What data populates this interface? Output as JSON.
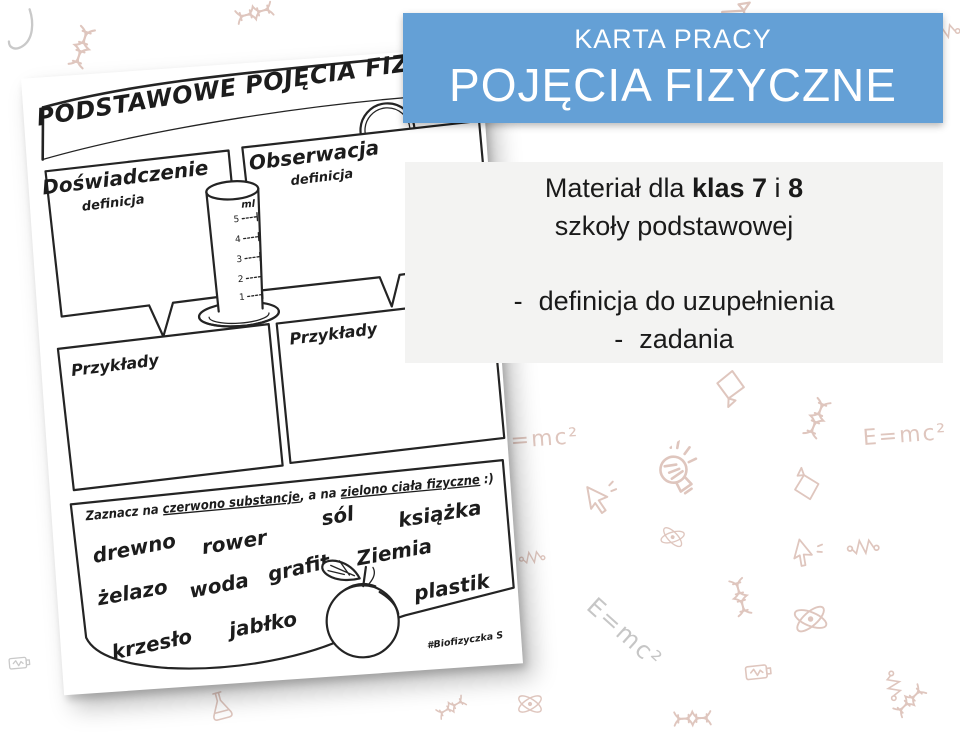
{
  "slide": {
    "background_color": "#ffffff",
    "banner": {
      "kicker": "KARTA PRACY",
      "title": "POJĘCIA FIZYCZNE",
      "bg_color": "#64a0d6",
      "text_color": "#ffffff"
    },
    "info_box": {
      "bg_color": "#f3f3f2",
      "audience_prefix": "Materiał dla ",
      "audience_bold_1": "klas 7",
      "audience_mid": " i ",
      "audience_bold_2": "8",
      "audience_line2": "szkoły podstawowej",
      "bullet_dash": "-",
      "bullets": [
        "definicja do uzupełnienia",
        "zadania"
      ]
    }
  },
  "worksheet": {
    "title": "PODSTAWOWE POJĘCIA FIZYCZNE",
    "experiment": {
      "label": "Doświadczenie",
      "sublabel": "definicja"
    },
    "observation": {
      "label": "Obserwacja",
      "sublabel": "definicja"
    },
    "cylinder": {
      "unit": "ml",
      "ticks": [
        "5",
        "4",
        "3",
        "2",
        "1"
      ]
    },
    "examples_left_label": "Przykłady",
    "examples_right_label": "Przykłady",
    "task": {
      "part1": "Zaznacz na ",
      "underline1": "czerwono substancje",
      "part2": ", a na ",
      "underline2": "zielono ciała fizyczne",
      "part3": " :)"
    },
    "words": [
      "drewno",
      "rower",
      "sól",
      "książka",
      "żelazo",
      "woda",
      "grafit",
      "Ziemia",
      "plastik",
      "krzesło",
      "jabłko"
    ],
    "signature": "#Biofizyczka S"
  },
  "background_doodles": {
    "color": "#dfc6be",
    "alt_color": "#c9c9c9",
    "emc2_text": "E=mc²",
    "sup_fragment": "2",
    "types": [
      "dna",
      "atom",
      "bulb",
      "flask",
      "megaphone",
      "magnet",
      "battery",
      "cursor",
      "resistor",
      "hook"
    ]
  }
}
